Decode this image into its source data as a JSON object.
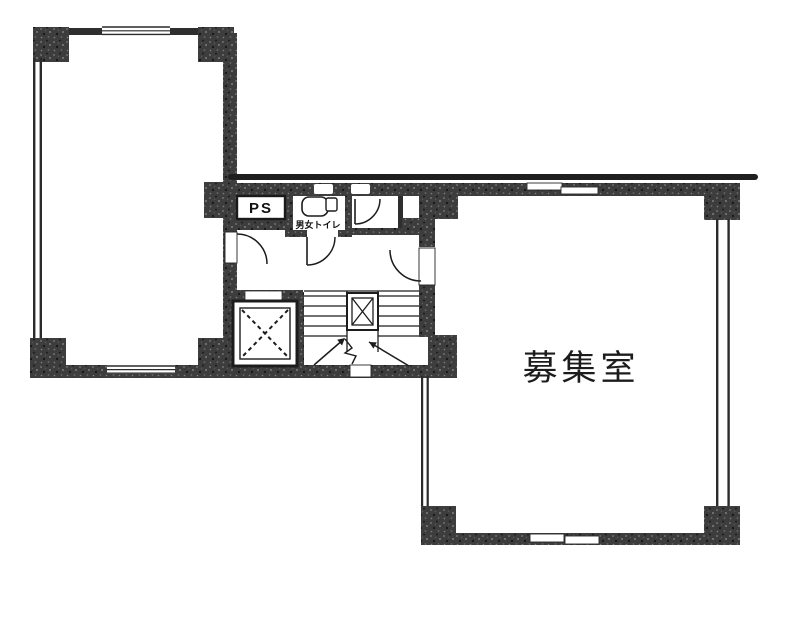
{
  "page": {
    "background": "#ffffff",
    "wall_color": "#3a3a3a",
    "line_color": "#1f1f1f",
    "text_color": "#1c1c1c"
  },
  "labels": {
    "pipe_space": "PS",
    "toilet": "男女トイレ",
    "vacant_room": "募集室"
  }
}
